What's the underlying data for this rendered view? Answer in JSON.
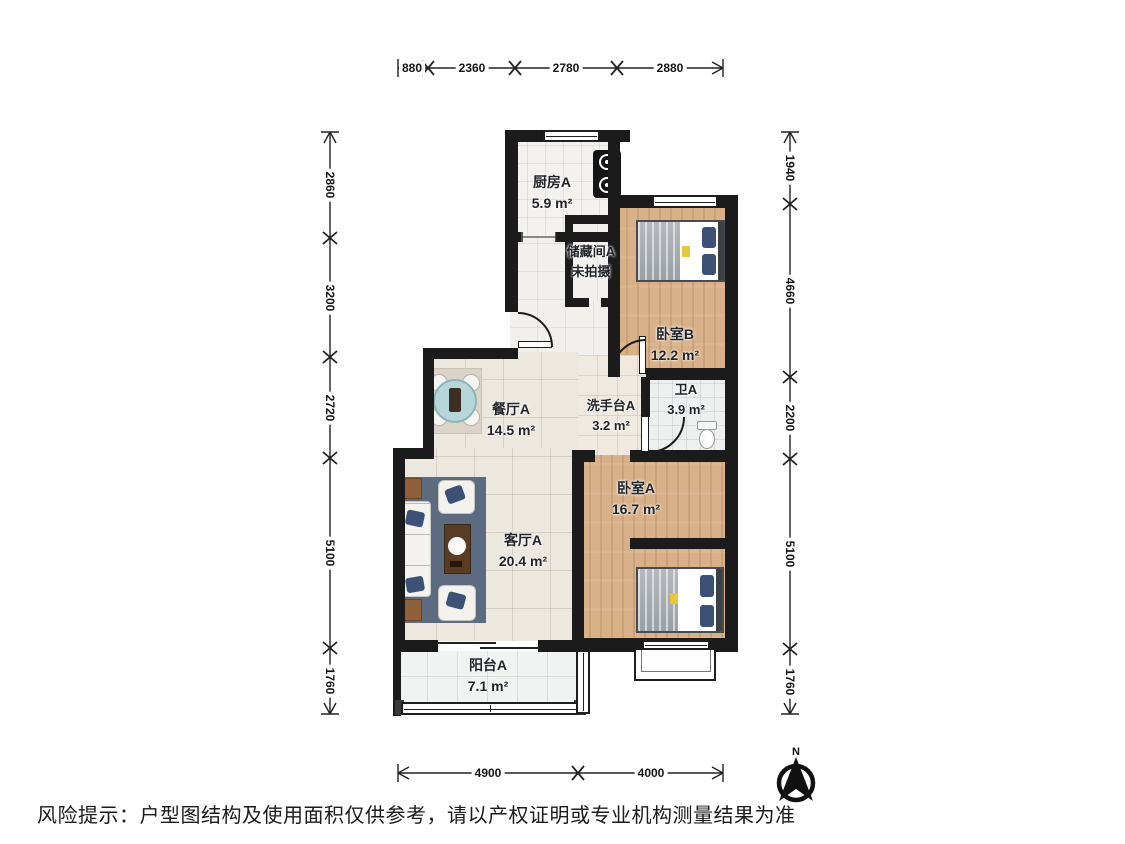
{
  "plan": {
    "rooms": {
      "kitchen": {
        "name": "厨房A",
        "area": "5.9 m²"
      },
      "storage": {
        "name": "储藏间A",
        "area": "未拍摄"
      },
      "bedroom_b": {
        "name": "卧室B",
        "area": "12.2 m²"
      },
      "dining": {
        "name": "餐厅A",
        "area": "14.5 m²"
      },
      "washstand": {
        "name": "洗手台A",
        "area": "3.2 m²"
      },
      "bathroom": {
        "name": "卫A",
        "area": "3.9 m²"
      },
      "bedroom_a": {
        "name": "卧室A",
        "area": "16.7 m²"
      },
      "living": {
        "name": "客厅A",
        "area": "20.4 m²"
      },
      "balcony": {
        "name": "阳台A",
        "area": "7.1 m²"
      }
    },
    "dimensions": {
      "top": [
        "880",
        "2360",
        "2780",
        "2880"
      ],
      "bottom": [
        "4900",
        "4000"
      ],
      "left": [
        "2860",
        "3200",
        "2720",
        "5100",
        "1760"
      ],
      "right": [
        "1940",
        "4660",
        "2200",
        "5100",
        "1760"
      ]
    },
    "compass": {
      "label": "N"
    },
    "disclaimer": "风险提示：户型图结构及使用面积仅供参考，请以产权证明或专业机构测量结果为准",
    "colors": {
      "wall": "#1b1b1b",
      "wood_floor": "#d8b189",
      "tile_floor": "#ece7df",
      "living_rug": "#5d6b81",
      "pillow_navy": "#3d5176",
      "dining_table_teal": "#b7d6da"
    }
  }
}
